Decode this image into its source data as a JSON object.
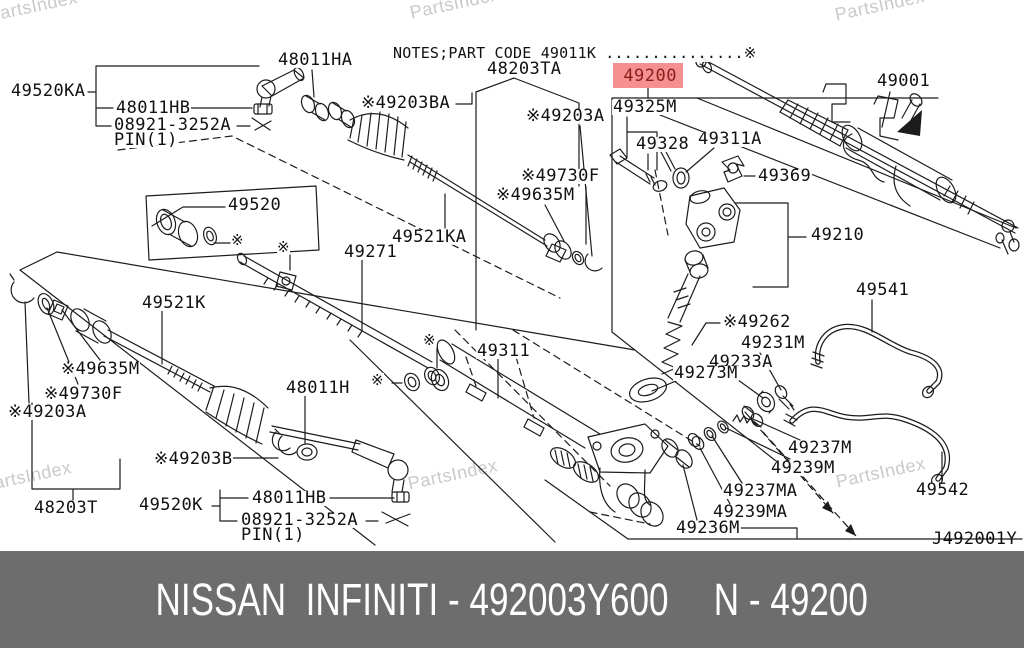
{
  "watermark_text": "PartsIndex",
  "watermarks": [
    {
      "x": -14,
      "y": 6
    },
    {
      "x": 408,
      "y": 3
    },
    {
      "x": 833,
      "y": 5
    },
    {
      "x": -20,
      "y": 476
    },
    {
      "x": 406,
      "y": 474
    },
    {
      "x": 834,
      "y": 472
    }
  ],
  "diagram": {
    "note_line": "NOTES;PART CODE 49011K ...............※",
    "drawing_code": "J492001Y",
    "highlighted_part": {
      "text": "49200"
    },
    "labels": [
      {
        "id": "49520KA",
        "text": "49520KA",
        "x": 10,
        "y": 84
      },
      {
        "id": "48011HB-top",
        "text": "48011HB",
        "x": 115,
        "y": 101
      },
      {
        "id": "08921-3252A-top",
        "text": "08921-3252A",
        "x": 113,
        "y": 118
      },
      {
        "id": "PIN1-top",
        "text": "PIN(1)",
        "x": 113,
        "y": 133
      },
      {
        "id": "48011HA",
        "text": "48011HA",
        "x": 277,
        "y": 53
      },
      {
        "id": "48203TA",
        "text": "48203TA",
        "x": 486,
        "y": 62
      },
      {
        "id": "49203BA",
        "text": "※49203BA",
        "x": 360,
        "y": 96
      },
      {
        "id": "49203A-top",
        "text": "※49203A",
        "x": 525,
        "y": 109
      },
      {
        "id": "49325M",
        "text": "49325M",
        "x": 612,
        "y": 100
      },
      {
        "id": "49328",
        "text": "49328",
        "x": 635,
        "y": 137
      },
      {
        "id": "49311A",
        "text": "49311A",
        "x": 697,
        "y": 132
      },
      {
        "id": "49369",
        "text": "49369",
        "x": 757,
        "y": 169
      },
      {
        "id": "49001",
        "text": "49001",
        "x": 876,
        "y": 74
      },
      {
        "id": "49730F-top",
        "text": "※49730F",
        "x": 520,
        "y": 169
      },
      {
        "id": "49635M-top",
        "text": "※49635M",
        "x": 495,
        "y": 188
      },
      {
        "id": "49520",
        "text": "49520",
        "x": 227,
        "y": 198
      },
      {
        "id": "49521KA",
        "text": "49521KA",
        "x": 391,
        "y": 230
      },
      {
        "id": "49271",
        "text": "49271",
        "x": 343,
        "y": 245
      },
      {
        "id": "49210",
        "text": "49210",
        "x": 810,
        "y": 228
      },
      {
        "id": "49521K",
        "text": "49521K",
        "x": 141,
        "y": 296
      },
      {
        "id": "49635M-left",
        "text": "※49635M",
        "x": 60,
        "y": 362
      },
      {
        "id": "49730F-left",
        "text": "※49730F",
        "x": 43,
        "y": 387
      },
      {
        "id": "49203A-left",
        "text": "※49203A",
        "x": 7,
        "y": 405
      },
      {
        "id": "48011H",
        "text": "48011H",
        "x": 285,
        "y": 381
      },
      {
        "id": "49203B",
        "text": "※49203B",
        "x": 153,
        "y": 452
      },
      {
        "id": "48203T",
        "text": "48203T",
        "x": 33,
        "y": 501
      },
      {
        "id": "49520K",
        "text": "49520K",
        "x": 138,
        "y": 498
      },
      {
        "id": "48011HB-bottom",
        "text": "48011HB",
        "x": 251,
        "y": 491
      },
      {
        "id": "08921-3252A-bottom",
        "text": "08921-3252A",
        "x": 240,
        "y": 513
      },
      {
        "id": "PIN1-bottom",
        "text": "PIN(1)",
        "x": 240,
        "y": 528
      },
      {
        "id": "49311",
        "text": "49311",
        "x": 476,
        "y": 344
      },
      {
        "id": "49262",
        "text": "※49262",
        "x": 722,
        "y": 315
      },
      {
        "id": "49231M",
        "text": "49231M",
        "x": 740,
        "y": 336
      },
      {
        "id": "49233A",
        "text": "49233A",
        "x": 708,
        "y": 355
      },
      {
        "id": "49273M",
        "text": "49273M",
        "x": 673,
        "y": 366
      },
      {
        "id": "49541",
        "text": "49541",
        "x": 855,
        "y": 283
      },
      {
        "id": "49542",
        "text": "49542",
        "x": 915,
        "y": 483
      },
      {
        "id": "49237M",
        "text": "49237M",
        "x": 787,
        "y": 441
      },
      {
        "id": "49239M",
        "text": "49239M",
        "x": 770,
        "y": 461
      },
      {
        "id": "49237MA",
        "text": "49237MA",
        "x": 722,
        "y": 484
      },
      {
        "id": "49239MA",
        "text": "49239MA",
        "x": 712,
        "y": 505
      },
      {
        "id": "49236M",
        "text": "49236M",
        "x": 675,
        "y": 521
      }
    ],
    "stars": [
      {
        "x": 231,
        "y": 233
      },
      {
        "x": 277,
        "y": 240
      },
      {
        "x": 423,
        "y": 333
      },
      {
        "x": 371,
        "y": 373
      }
    ],
    "colors": {
      "background": "#ffffff",
      "line": "#1c1c1c",
      "watermark": "#c9c9c9",
      "highlight_bg": "#f59090",
      "highlight_fg": "#8c1d1d"
    }
  },
  "footer": {
    "left_text": "NISSAN  INFINITI - 492003Y600",
    "right_text": "N - 49200",
    "bg": "#6d6d6d",
    "fg": "#ffffff"
  }
}
